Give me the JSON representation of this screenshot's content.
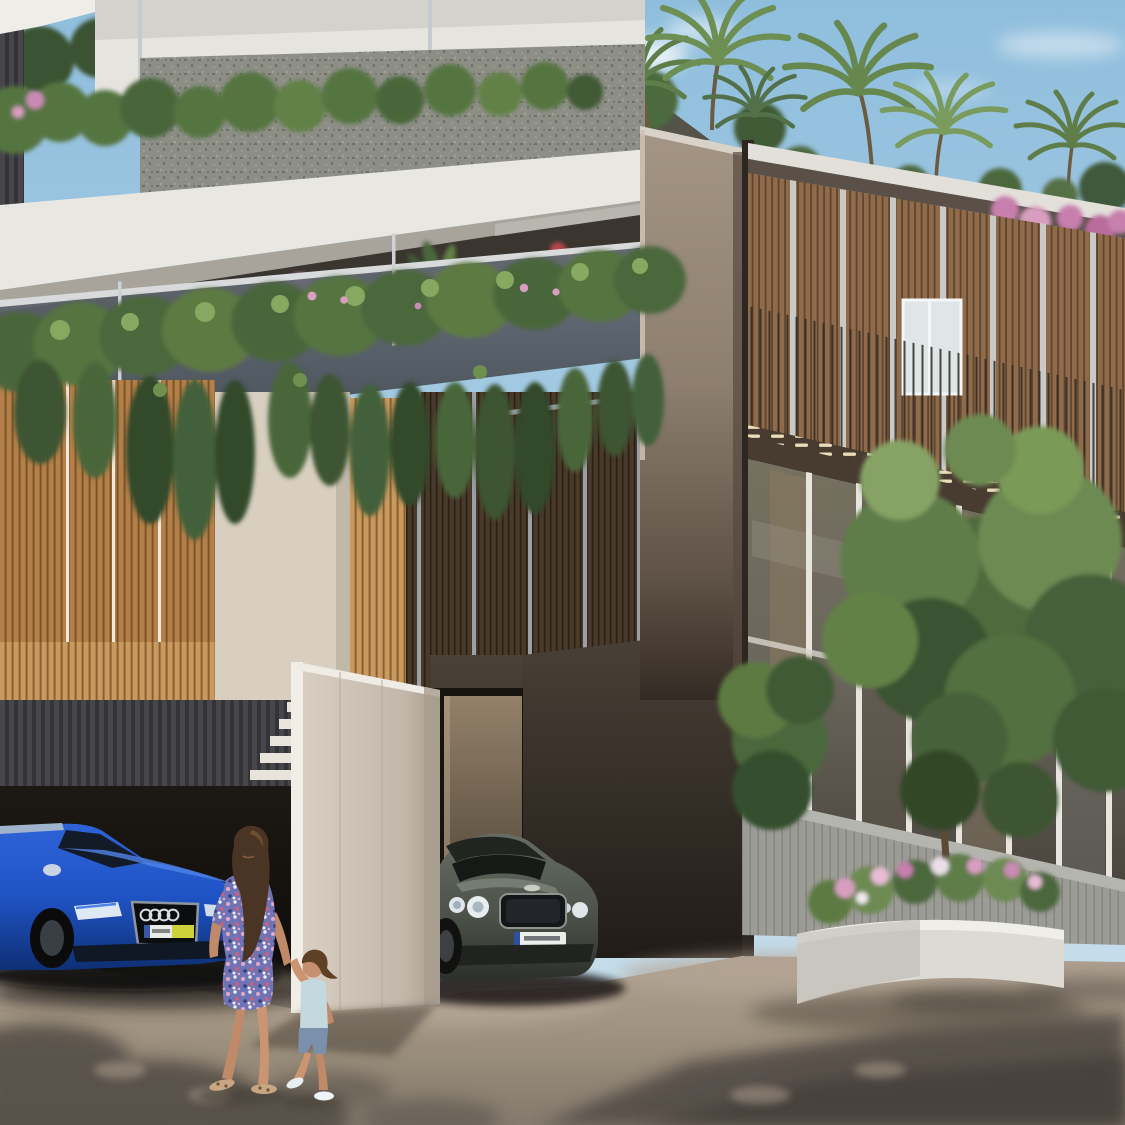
{
  "meta": {
    "title": "Architectural rendering — modern residential townhouses",
    "description": "Photorealistic architectural rendering of a modern luxury townhouse complex with wooden louver facades, cascading balcony greenery and rooftop palm trees. A blue Audi SUV is parked in a dark garage at left, a grey Bentley coupe is parked by the entrance, and a woman in a floral dress walks hand-in-hand with a little girl across the sunlit street. A white stone planter with pink flowers and trees stands in front of the glass-walled right building."
  },
  "scene": {
    "sky": {
      "top_color": "#8fbedd",
      "horizon_color": "#cfe3ee",
      "clouds": 3
    },
    "left_building": {
      "elements": [
        "white cantilevered slab bands",
        "stone-textured parapet wall",
        "rooftop hedge",
        "glass balustrade balcony with plants",
        "cascading hanging vines",
        "golden wood slat panels",
        "beige render panels",
        "dark timber louver screens with grey dividers",
        "dark ribbed garage band",
        "garage opening",
        "white angled gate pier with stepped detail"
      ]
    },
    "central_tower": {
      "color": "#9a8c7c",
      "base": "dark brown shadowed wall with recessed entry door"
    },
    "right_building": {
      "floors": 2,
      "elements": [
        "white roof fascia",
        "rooftop palms and pink bougainvillea",
        "vertical timber louver upper floor with balustrade and white window",
        "dark timber fascia band with sunlit highlights",
        "full-height glass ground floor with mullions",
        "grey boundary fence",
        "two green trees",
        "white concrete planter with pink and white flowers"
      ]
    },
    "vehicles": {
      "audi": {
        "type": "blue SUV parked in garage",
        "body_color": "#1f53c4",
        "grille": "black octagon with four chrome rings",
        "plate": "white with yellow segment (illegible)"
      },
      "bentley": {
        "type": "grey-green coupe",
        "body_color": "#51574f",
        "headlights": "twin round lamps",
        "plate": "white with blue band (illegible)"
      }
    },
    "people": {
      "woman": {
        "hair": "long dark brown",
        "dress": "blue-purple floral mini dress",
        "footwear": "flat sandals"
      },
      "child": {
        "top": "light blue tank top",
        "bottom": "denim shorts",
        "footwear": "white sneakers"
      }
    },
    "road": {
      "lit_color": "#a79a8b",
      "shadow_color": "#56504a",
      "features": [
        "dappled tree shadows",
        "building shadow lower right",
        "sunlit driveway apron"
      ]
    }
  },
  "palette": {
    "white_slab": "#e9e7e1",
    "stone_wall": "#8d8e86",
    "vine_green": "#55743f",
    "vine_dark": "#33492a",
    "gold_wood": "#b3804a",
    "beige_panel": "#d8cfc0",
    "dark_slat": "#493a2b",
    "divider_grey": "#9aa0a5",
    "tower_light": "#a49585",
    "dark_wall": "#2a241f",
    "right_wood": "#8f6b49",
    "mullion": "#c9c9c7",
    "fence_grey": "#9c9c97",
    "planter_white": "#dcdad2",
    "skin": "#c08a68",
    "hair_brown": "#4a3424",
    "dress_base": "#6e74b5",
    "child_top": "#c3d9de",
    "denim": "#7a90ac"
  }
}
